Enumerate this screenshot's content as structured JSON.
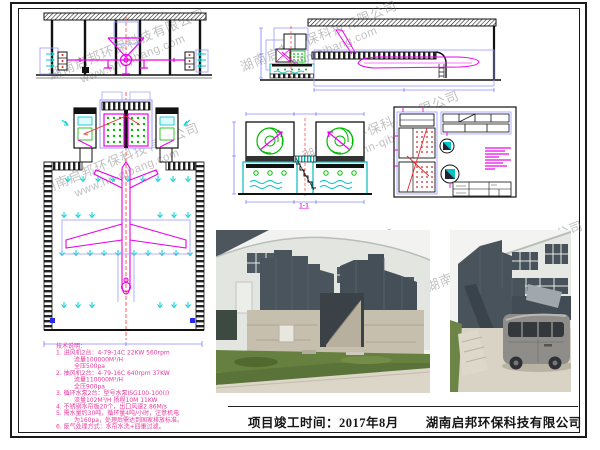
{
  "watermark": {
    "company": "湖南启邦环保科技有限公司",
    "url": "www.hn-qibang.com"
  },
  "footer": {
    "completion": "项目竣工时间：2017年8月",
    "company": "湖南启邦环保科技有限公司"
  },
  "tech_notes": {
    "title": "技术说明：",
    "lines": [
      "1. 进风机2台：4-79-14C  22KW  560rpm",
      "流量100000M³/H",
      "全压500pa",
      "2. 抽风机2台：4-79-16C 640rpm 37KW",
      "流量110000M³/H",
      "全压900pa",
      "3. 循环水泵2台：型号水泵ISG100-100(I)",
      "流量102M³/H  扬程10M  11KW",
      "4. 不锈钢水帘板20个，出口风速2.86M/s",
      "5. 需水量约30吨，循环量4吨/小时，注意机电",
      "为160pa，处理后需达到国家排放标准。",
      "6. 废气处理方式：水帘水洗+四重过滤。"
    ]
  },
  "section_label": "1-1",
  "colors": {
    "magenta": "#ee00ee",
    "cyan": "#00c5c5",
    "green": "#00bb00",
    "dim_blue": "#9b9bff",
    "red": "#ee2222",
    "note_pink": "#e9379d",
    "equipment_slate": "#4a545c"
  }
}
